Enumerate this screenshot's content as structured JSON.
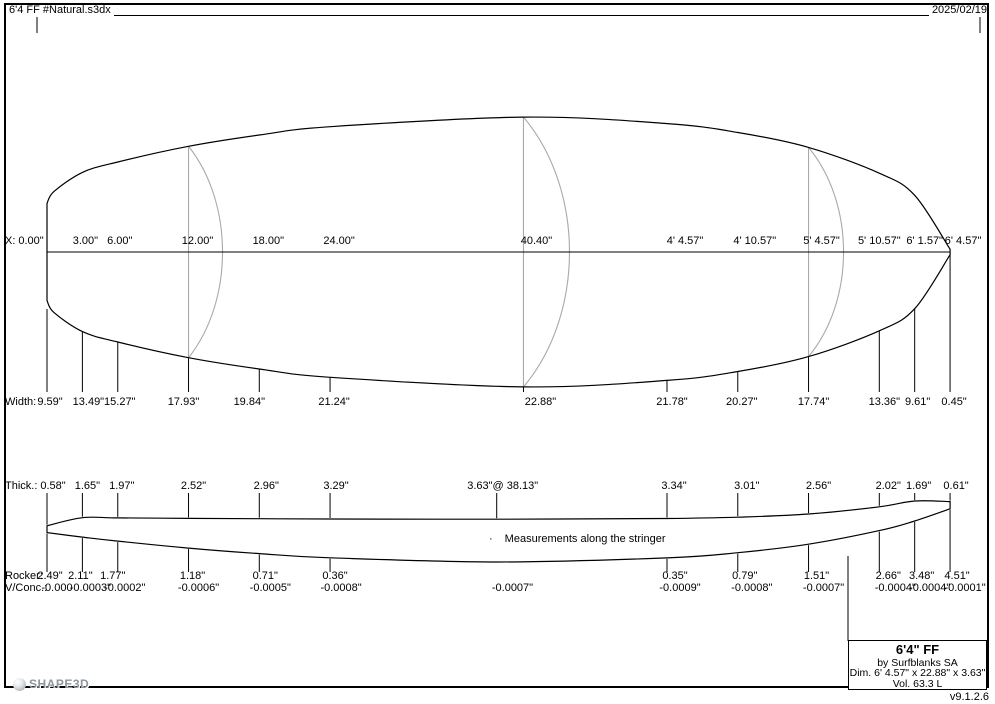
{
  "header": {
    "filename": "6'4 FF #Natural.s3dx",
    "date": "2025/02/19"
  },
  "note": {
    "bullet": "·",
    "text": "Measurements along the stringer"
  },
  "info_box": {
    "title": "6'4\" FF",
    "maker": "by Surfblanks SA",
    "dims": "Dim. 6' 4.57\" x 22.88\" x 3.63\"",
    "volume": "Vol. 63.3 L"
  },
  "footer": {
    "logo": "SHAPE3D",
    "version": "v9.1.2.6"
  },
  "colors": {
    "text": "#000000",
    "line": "#000000",
    "section_line": "#a9a9a9",
    "logo_gray": "#8f959b"
  },
  "geometry": {
    "ppi": 11.794,
    "x0": 47,
    "center_y": 252,
    "base_y": 562,
    "length_in": 76.57,
    "plan_stations_in": [
      0,
      3,
      6,
      12,
      18,
      24,
      40.4,
      52.57,
      58.57,
      64.57,
      70.57,
      73.57,
      76.57
    ],
    "plan_widths_in": [
      9.59,
      13.49,
      15.27,
      17.93,
      19.84,
      21.24,
      22.88,
      21.78,
      20.27,
      17.74,
      13.36,
      9.61,
      0.45
    ],
    "profile_stations_in": [
      0,
      3,
      6,
      12,
      18,
      24,
      38.13,
      52.57,
      58.57,
      64.57,
      70.57,
      73.57,
      76.57
    ],
    "profile_rocker_in": [
      2.49,
      2.11,
      1.77,
      1.18,
      0.71,
      0.36,
      0,
      0.35,
      0.79,
      1.51,
      2.66,
      3.48,
      4.51
    ],
    "profile_thickness_in": [
      0.58,
      1.65,
      1.97,
      2.52,
      2.96,
      3.29,
      3.63,
      3.34,
      3.01,
      2.56,
      2.02,
      1.69,
      0.61
    ],
    "cross_sections": [
      {
        "in": 12,
        "bulge_px": 34
      },
      {
        "in": 40.4,
        "bulge_px": 46
      },
      {
        "in": 64.57,
        "bulge_px": 35
      }
    ],
    "width_tick_bottom_y": 392,
    "thick_tick_top_y": 493,
    "rocker_tick_bottom_y": 572
  },
  "rows": {
    "x": {
      "prefix": "X:",
      "top": 235,
      "items": [
        {
          "in": 0,
          "label": "0.00\"",
          "dx": -16
        },
        {
          "in": 3,
          "label": "3.00\"",
          "dx": 3
        },
        {
          "in": 6,
          "label": "6.00\"",
          "dx": 2
        },
        {
          "in": 12,
          "label": "12.00\"",
          "dx": 9
        },
        {
          "in": 18,
          "label": "18.00\"",
          "dx": 9
        },
        {
          "in": 24,
          "label": "24.00\"",
          "dx": 9
        },
        {
          "in": 40.4,
          "label": "40.40\"",
          "dx": 13
        },
        {
          "in": 52.57,
          "label": "4' 4.57\"",
          "dx": 18
        },
        {
          "in": 58.57,
          "label": "4' 10.57\"",
          "dx": 17
        },
        {
          "in": 64.57,
          "label": "5' 4.57\"",
          "dx": 13
        },
        {
          "in": 70.57,
          "label": "5' 10.57\"",
          "dx": 0
        },
        {
          "in": 73.57,
          "label": "6' 1.57\"",
          "dx": 10
        },
        {
          "in": 76.57,
          "label": "6' 4.57\"",
          "dx": 13
        }
      ]
    },
    "width": {
      "prefix": "Width:",
      "top": 396,
      "items": [
        {
          "in": 0,
          "label": "9.59\"",
          "dx": 3
        },
        {
          "in": 3,
          "label": "13.49\"",
          "dx": 6
        },
        {
          "in": 6,
          "label": "15.27\"",
          "dx": 2
        },
        {
          "in": 12,
          "label": "17.93\"",
          "dx": -5
        },
        {
          "in": 18,
          "label": "19.84\"",
          "dx": -10
        },
        {
          "in": 24,
          "label": "21.24\"",
          "dx": 4
        },
        {
          "in": 40.4,
          "label": "22.88\"",
          "dx": 17
        },
        {
          "in": 52.57,
          "label": "21.78\"",
          "dx": 5
        },
        {
          "in": 58.57,
          "label": "20.27\"",
          "dx": 4
        },
        {
          "in": 64.57,
          "label": "17.74\"",
          "dx": 5
        },
        {
          "in": 70.57,
          "label": "13.36\"",
          "dx": 5
        },
        {
          "in": 73.57,
          "label": "9.61\"",
          "dx": 3
        },
        {
          "in": 76.57,
          "label": "0.45\"",
          "dx": 4
        }
      ]
    },
    "thick": {
      "prefix": "Thick.:",
      "top": 480,
      "items": [
        {
          "in": 0,
          "label": "0.58\"",
          "dx": 6
        },
        {
          "in": 3,
          "label": "1.65\"",
          "dx": 5
        },
        {
          "in": 6,
          "label": "1.97\"",
          "dx": 4
        },
        {
          "in": 12,
          "label": "2.52\"",
          "dx": 5
        },
        {
          "in": 18,
          "label": "2.96\"",
          "dx": 7
        },
        {
          "in": 24,
          "label": "3.29\"",
          "dx": 6
        },
        {
          "in": 38.13,
          "label": "3.63\"@ 38.13\"",
          "dx": 6
        },
        {
          "in": 52.57,
          "label": "3.34\"",
          "dx": 7
        },
        {
          "in": 58.57,
          "label": "3.01\"",
          "dx": 9
        },
        {
          "in": 64.57,
          "label": "2.56\"",
          "dx": 10
        },
        {
          "in": 70.57,
          "label": "2.02\"",
          "dx": 9
        },
        {
          "in": 73.57,
          "label": "1.69\"",
          "dx": 4
        },
        {
          "in": 76.57,
          "label": "0.61\"",
          "dx": 6
        }
      ]
    },
    "rocker": {
      "prefix": "Rocker:",
      "top": 570,
      "items": [
        {
          "in": 0,
          "label": "2.49\"",
          "dx": 3
        },
        {
          "in": 3,
          "label": "2.11\"",
          "dx": -2
        },
        {
          "in": 6,
          "label": "1.77\"",
          "dx": -5
        },
        {
          "in": 12,
          "label": "1.18\"",
          "dx": 4
        },
        {
          "in": 18,
          "label": "0.71\"",
          "dx": 6
        },
        {
          "in": 24,
          "label": "0.36\"",
          "dx": 5
        },
        {
          "in": 52.57,
          "label": "0.35\"",
          "dx": 8
        },
        {
          "in": 58.57,
          "label": "0.79\"",
          "dx": 7
        },
        {
          "in": 64.57,
          "label": "1.51\"",
          "dx": 8
        },
        {
          "in": 70.57,
          "label": "2.66\"",
          "dx": 9
        },
        {
          "in": 73.57,
          "label": "3.48\"",
          "dx": 7
        },
        {
          "in": 76.57,
          "label": "4.51\"",
          "dx": 7
        }
      ]
    },
    "vconc": {
      "prefix": "V/Conc.:",
      "top": 582,
      "items": [
        {
          "in": 0,
          "label": "-0.000",
          "dx": 10
        },
        {
          "in": 3,
          "label": "-0.0003\"",
          "dx": 8
        },
        {
          "in": 6,
          "label": "-0.0002\"",
          "dx": 7
        },
        {
          "in": 12,
          "label": "-0.0006\"",
          "dx": 10
        },
        {
          "in": 18,
          "label": "-0.0005\"",
          "dx": 11
        },
        {
          "in": 24,
          "label": "-0.0008\"",
          "dx": 11
        },
        {
          "in": 40.4,
          "label": "-0.0007\"",
          "dx": -11
        },
        {
          "in": 52.57,
          "label": "-0.0009\"",
          "dx": 13
        },
        {
          "in": 58.57,
          "label": "-0.0008\"",
          "dx": 14
        },
        {
          "in": 64.57,
          "label": "-0.0007\"",
          "dx": 15
        },
        {
          "in": 70.57,
          "label": "-0.0004\"",
          "dx": 16
        },
        {
          "in": 73.57,
          "label": "-0.0004\"",
          "dx": 15
        },
        {
          "in": 76.57,
          "label": "-0.0001\"",
          "dx": 15
        }
      ]
    }
  }
}
